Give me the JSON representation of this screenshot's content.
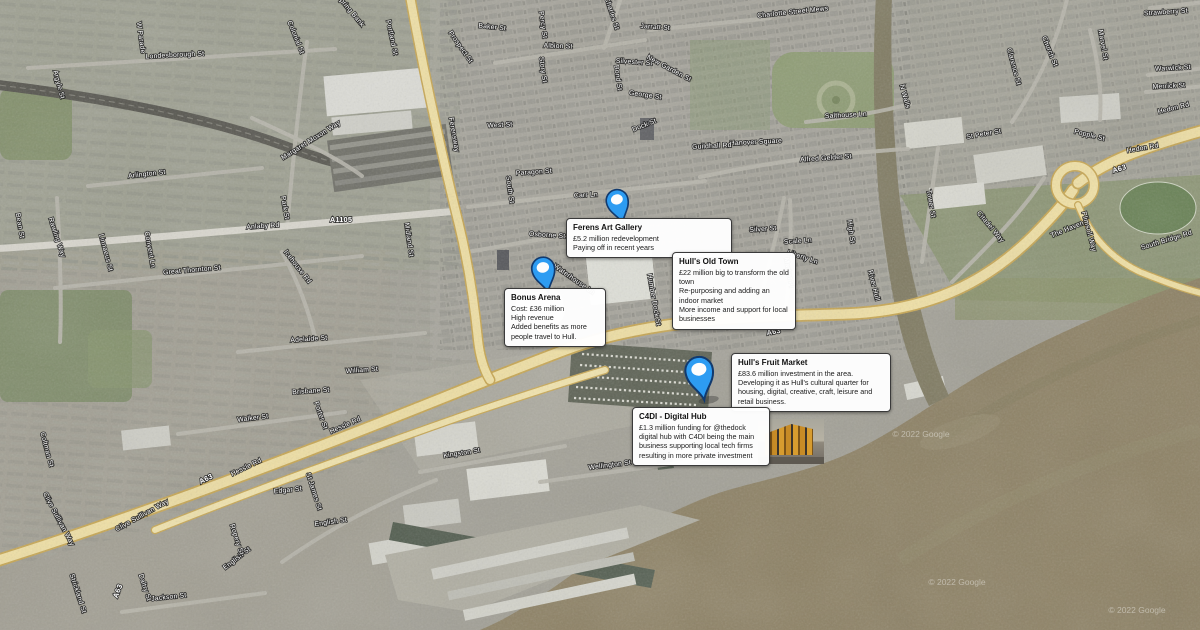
{
  "map": {
    "pin_color": "#2d9cf2",
    "pin_outline_color": "#123a6e",
    "road_color": "#f0e0a4",
    "water_color": "#8d8164",
    "watermarks": [
      {
        "text": "© 2022 Google",
        "x": 921,
        "y": 437
      },
      {
        "text": "© 2022 Google",
        "x": 957,
        "y": 585
      },
      {
        "text": "© 2022 Google",
        "x": 1137,
        "y": 613
      }
    ],
    "street_labels": [
      {
        "t": "Londesborough St",
        "x": 175,
        "y": 57,
        "r": -3
      },
      {
        "t": "Portland St",
        "x": 390,
        "y": 38,
        "r": 78
      },
      {
        "t": "Prospect St",
        "x": 459,
        "y": 48,
        "r": 55
      },
      {
        "t": "W Parade",
        "x": 139,
        "y": 38,
        "r": 82
      },
      {
        "t": "Argyle St",
        "x": 57,
        "y": 85,
        "r": 75
      },
      {
        "t": "Colonial St",
        "x": 294,
        "y": 38,
        "r": 68
      },
      {
        "t": "Park St",
        "x": 283,
        "y": 208,
        "r": 80
      },
      {
        "t": "Margaret Moxon Way",
        "x": 312,
        "y": 142,
        "r": -32
      },
      {
        "t": "Arlington St",
        "x": 147,
        "y": 176,
        "r": -6
      },
      {
        "t": "Spring Bank",
        "x": 349,
        "y": 12,
        "r": 50
      },
      {
        "t": "Baker St",
        "x": 492,
        "y": 29,
        "r": 6
      },
      {
        "t": "Percy St",
        "x": 541,
        "y": 25,
        "r": 82
      },
      {
        "t": "Albion St",
        "x": 558,
        "y": 48,
        "r": 2
      },
      {
        "t": "Story St",
        "x": 541,
        "y": 70,
        "r": 82
      },
      {
        "t": "Bond St",
        "x": 616,
        "y": 78,
        "r": 82
      },
      {
        "t": "Charles St",
        "x": 610,
        "y": 14,
        "r": 72
      },
      {
        "t": "Jarratt St",
        "x": 655,
        "y": 29,
        "r": 4
      },
      {
        "t": "Silvester St",
        "x": 634,
        "y": 64,
        "r": 4
      },
      {
        "t": "New Garden St",
        "x": 668,
        "y": 70,
        "r": 28
      },
      {
        "t": "George St",
        "x": 645,
        "y": 97,
        "r": 8
      },
      {
        "t": "Charlotte Street Mews",
        "x": 793,
        "y": 14,
        "r": -6
      },
      {
        "t": "Dock St",
        "x": 645,
        "y": 127,
        "r": -22
      },
      {
        "t": "West St",
        "x": 500,
        "y": 127,
        "r": -3
      },
      {
        "t": "Paragon St",
        "x": 534,
        "y": 174,
        "r": -4
      },
      {
        "t": "South St",
        "x": 508,
        "y": 190,
        "r": 82
      },
      {
        "t": "Carr Ln",
        "x": 586,
        "y": 197,
        "r": -3
      },
      {
        "t": "Osborne St",
        "x": 547,
        "y": 237,
        "r": 4
      },
      {
        "t": "Midland St",
        "x": 407,
        "y": 240,
        "r": 82
      },
      {
        "t": "Ferensway",
        "x": 452,
        "y": 135,
        "r": 80
      },
      {
        "t": "Anlaby Rd",
        "x": 263,
        "y": 228,
        "r": -4
      },
      {
        "t": "A1105",
        "x": 341,
        "y": 222,
        "r": 0,
        "b": 1
      },
      {
        "t": "Bean St",
        "x": 18,
        "y": 226,
        "r": 80
      },
      {
        "t": "Rawling Way",
        "x": 55,
        "y": 238,
        "r": 72
      },
      {
        "t": "Convent Ln",
        "x": 148,
        "y": 250,
        "r": 80
      },
      {
        "t": "Linnaeus St",
        "x": 104,
        "y": 253,
        "r": 75
      },
      {
        "t": "Great Thornton St",
        "x": 192,
        "y": 272,
        "r": -5
      },
      {
        "t": "Icehouse Rd",
        "x": 296,
        "y": 268,
        "r": 52
      },
      {
        "t": "Adelaide St",
        "x": 309,
        "y": 341,
        "r": -4
      },
      {
        "t": "William St",
        "x": 362,
        "y": 372,
        "r": -4
      },
      {
        "t": "Brisbane St",
        "x": 311,
        "y": 393,
        "r": -4
      },
      {
        "t": "Walker St",
        "x": 253,
        "y": 420,
        "r": -7
      },
      {
        "t": "Porter St",
        "x": 319,
        "y": 416,
        "r": 70
      },
      {
        "t": "Coltman St",
        "x": 45,
        "y": 450,
        "r": 75
      },
      {
        "t": "Hessle Rd",
        "x": 247,
        "y": 469,
        "r": -26
      },
      {
        "t": "A63",
        "x": 207,
        "y": 481,
        "r": -26,
        "b": 1
      },
      {
        "t": "Hessle Rd",
        "x": 346,
        "y": 427,
        "r": -24
      },
      {
        "t": "Clive Sullivan Way",
        "x": 143,
        "y": 517,
        "r": -29
      },
      {
        "t": "Clive Sullivan Way",
        "x": 57,
        "y": 520,
        "r": 62
      },
      {
        "t": "A63",
        "x": 120,
        "y": 592,
        "r": -68,
        "b": 1
      },
      {
        "t": "English St",
        "x": 331,
        "y": 524,
        "r": -8
      },
      {
        "t": "English St",
        "x": 238,
        "y": 560,
        "r": -38
      },
      {
        "t": "Edgar St",
        "x": 288,
        "y": 492,
        "r": -6
      },
      {
        "t": "St James St",
        "x": 312,
        "y": 492,
        "r": 72
      },
      {
        "t": "Ropery St",
        "x": 235,
        "y": 540,
        "r": 72
      },
      {
        "t": "Daltry St",
        "x": 143,
        "y": 588,
        "r": 72
      },
      {
        "t": "Jackson St",
        "x": 169,
        "y": 599,
        "r": -6
      },
      {
        "t": "Strickland St",
        "x": 76,
        "y": 594,
        "r": 72
      },
      {
        "t": "Kingston St",
        "x": 462,
        "y": 455,
        "r": -9
      },
      {
        "t": "Wellington St",
        "x": 610,
        "y": 467,
        "r": -7
      },
      {
        "t": "Humber Dock St",
        "x": 652,
        "y": 300,
        "r": 80
      },
      {
        "t": "Waterhouse Ln",
        "x": 573,
        "y": 281,
        "r": 35
      },
      {
        "t": "Alfred Gelder St",
        "x": 826,
        "y": 160,
        "r": -4
      },
      {
        "t": "Hanover Square",
        "x": 756,
        "y": 144,
        "r": -3
      },
      {
        "t": "Guildhall Rd",
        "x": 712,
        "y": 148,
        "r": -3
      },
      {
        "t": "N Walls",
        "x": 903,
        "y": 97,
        "r": 75
      },
      {
        "t": "Salthouse Ln",
        "x": 846,
        "y": 117,
        "r": -3
      },
      {
        "t": "Silver St",
        "x": 763,
        "y": 231,
        "r": -4
      },
      {
        "t": "Scale Ln",
        "x": 798,
        "y": 243,
        "r": -4
      },
      {
        "t": "Liberty Ln",
        "x": 802,
        "y": 259,
        "r": 18
      },
      {
        "t": "Market Pl",
        "x": 787,
        "y": 273,
        "r": 80
      },
      {
        "t": "High St",
        "x": 849,
        "y": 232,
        "r": 82
      },
      {
        "t": "River Hull",
        "x": 872,
        "y": 286,
        "r": 76
      },
      {
        "t": "St Peter St",
        "x": 984,
        "y": 136,
        "r": -10
      },
      {
        "t": "Popple St",
        "x": 1089,
        "y": 137,
        "r": 14
      },
      {
        "t": "Tower St",
        "x": 929,
        "y": 204,
        "r": 80
      },
      {
        "t": "Citadel Way",
        "x": 989,
        "y": 228,
        "r": 50
      },
      {
        "t": "The Haven",
        "x": 1068,
        "y": 231,
        "r": -22
      },
      {
        "t": "Plimsoll Way",
        "x": 1087,
        "y": 232,
        "r": 75
      },
      {
        "t": "South Bridge Rd",
        "x": 1167,
        "y": 242,
        "r": -17
      },
      {
        "t": "Hedon Rd",
        "x": 1143,
        "y": 150,
        "r": -10
      },
      {
        "t": "A63",
        "x": 1120,
        "y": 171,
        "r": -18,
        "b": 1
      },
      {
        "t": "A63",
        "x": 774,
        "y": 334,
        "r": -10,
        "b": 1
      },
      {
        "t": "Hedon Rd",
        "x": 1174,
        "y": 110,
        "r": -14
      },
      {
        "t": "Church St",
        "x": 1048,
        "y": 52,
        "r": 68
      },
      {
        "t": "Marvel St",
        "x": 1101,
        "y": 45,
        "r": 80
      },
      {
        "t": "Strawberry St",
        "x": 1166,
        "y": 14,
        "r": -4
      },
      {
        "t": "Warwick St",
        "x": 1173,
        "y": 70,
        "r": -3
      },
      {
        "t": "Merrick St",
        "x": 1169,
        "y": 88,
        "r": -3
      },
      {
        "t": "Clarence St",
        "x": 1012,
        "y": 67,
        "r": 75
      }
    ]
  },
  "markers": [
    {
      "title": "Ferens Art Gallery",
      "body": "£5.2 million redevelopment\nPaying off in recent years"
    },
    {
      "title": "Bonus Arena",
      "body": "Cost: £36 million\nHigh revenue\nAdded benefits as more people travel to Hull."
    },
    {
      "title": "Hull's Old Town",
      "body": "£22 million big to transform the old town\nRe-purposing and adding an indoor market\nMore income and support for local businesses"
    },
    {
      "title": "Hull's Fruit Market",
      "body": "£83.6 million investment in the area.\nDeveloping it as Hull's cultural quarter for housing, digital, creative, craft, leisure and retail business."
    },
    {
      "title": "C4DI - Digital Hub",
      "body": "£1.3 million funding for @thedock digital hub with C4DI being the main business supporting local tech firms resulting in more private investment"
    }
  ]
}
